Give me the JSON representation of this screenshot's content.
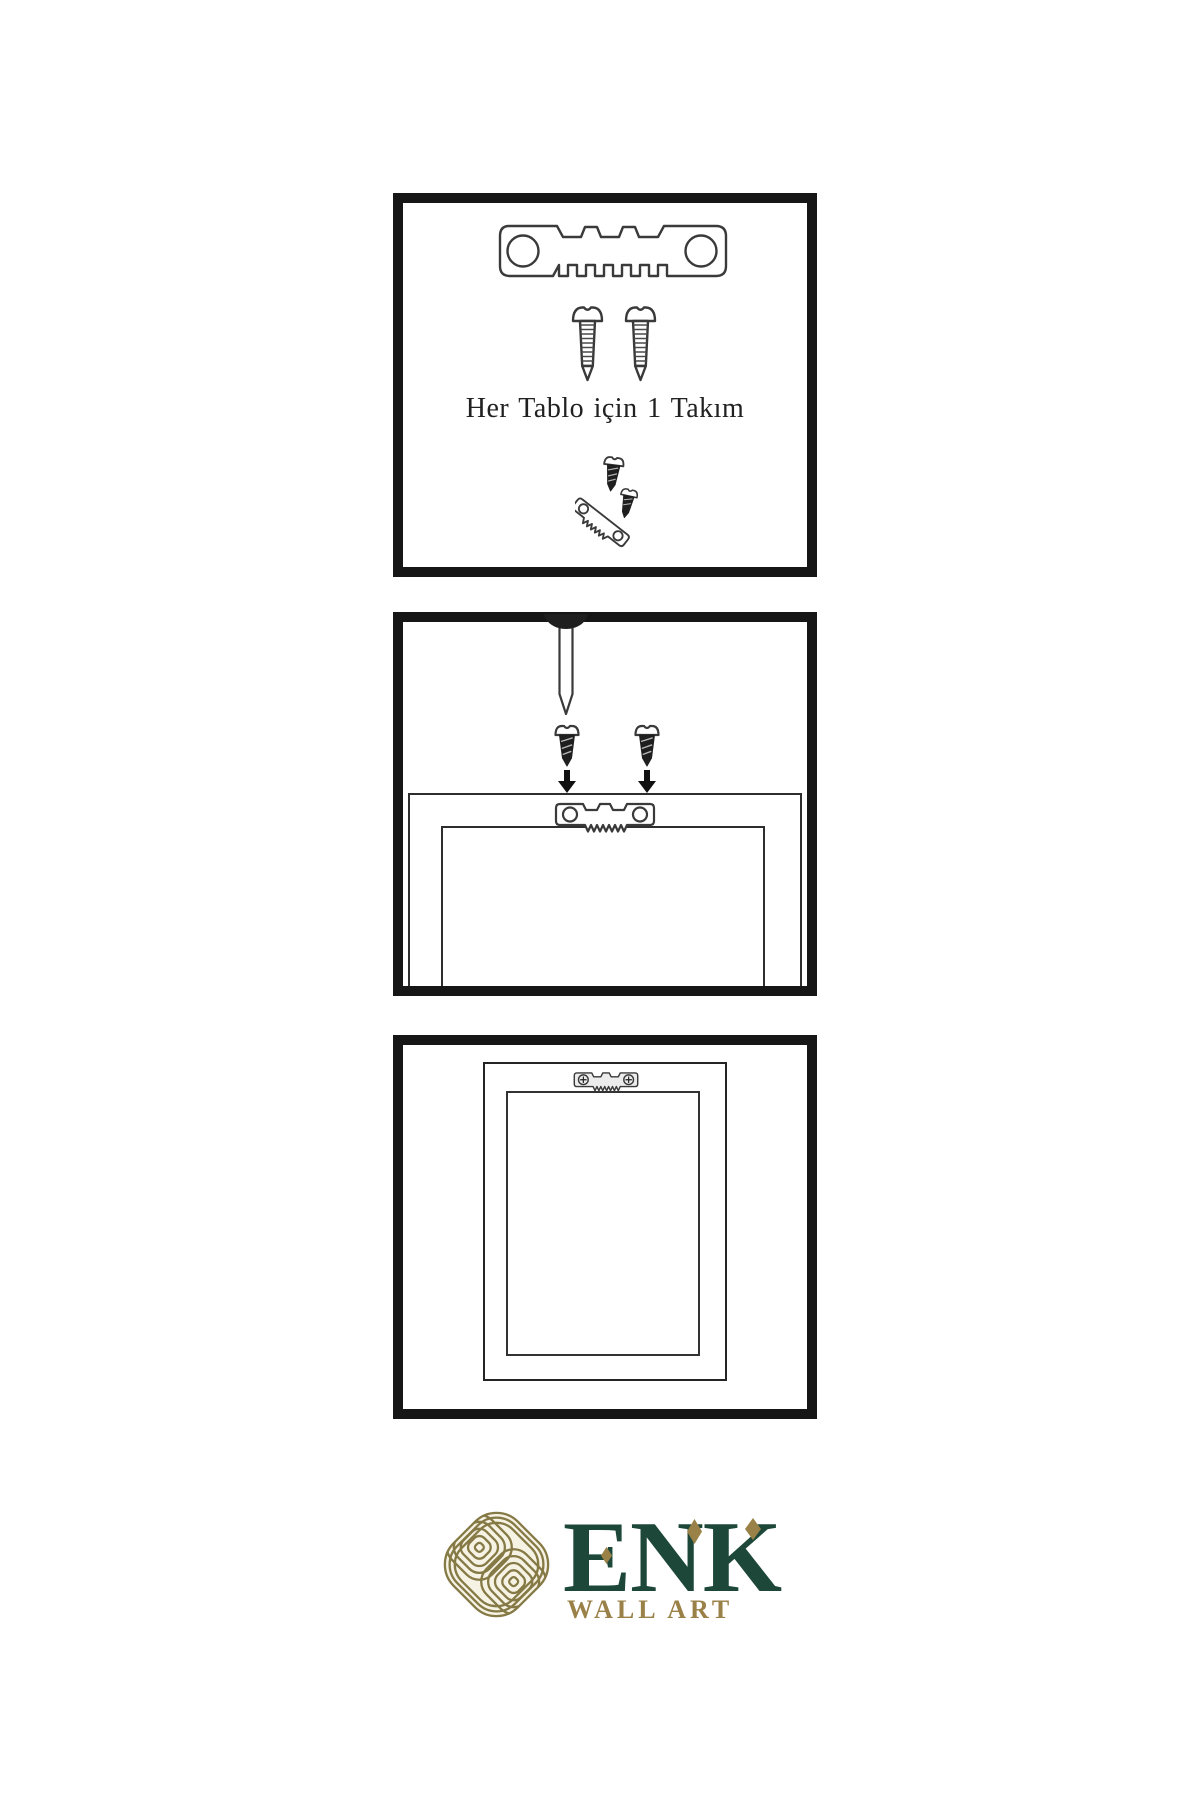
{
  "colors": {
    "paper": "#ffffff",
    "panel_border": "#161616",
    "line": "#3a3a3a",
    "dark_fill": "#1f1f1f",
    "text": "#212121",
    "brand_green": "#1d4839",
    "brand_gold": "#9a8148",
    "emblem_gold": "#857a46",
    "emblem_cream": "#f7f3e4"
  },
  "panels": {
    "kit": {
      "caption": "Her Tablo için 1 Takım",
      "icons": [
        "sawtooth-hanger-icon",
        "screw-icon",
        "screw-icon",
        "screw-and-hanger-assembly-icon"
      ]
    },
    "attach": {
      "icons": [
        "wall-nail-icon",
        "dark-screw-icon",
        "dark-screw-icon",
        "down-arrow-icon",
        "down-arrow-icon",
        "frame-back-outline",
        "sawtooth-hanger-small-icon"
      ]
    },
    "hang": {
      "icons": [
        "frame-front-outline",
        "mounted-hanger-icon"
      ]
    }
  },
  "brand": {
    "name": "ENK",
    "tagline": "WALL ART",
    "emblem": "knot-emblem-icon"
  }
}
